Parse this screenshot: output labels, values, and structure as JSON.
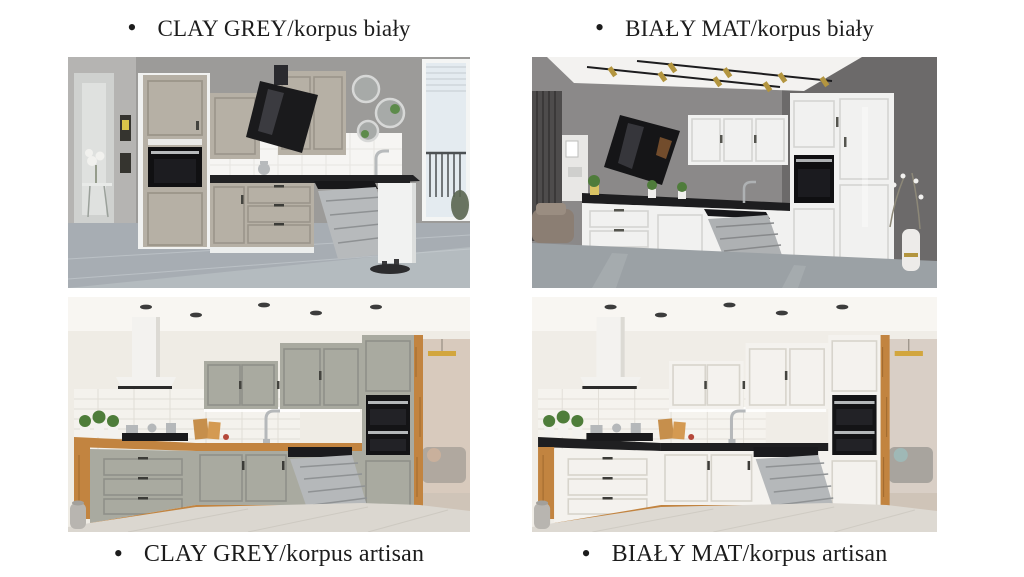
{
  "page": {
    "colors": {
      "bg": "#ffffff",
      "text": "#1c1c1c"
    }
  },
  "cards": [
    {
      "id": "clay-grey-korpus-bialy",
      "bullet": "•",
      "label": "CLAY GREY/korpus biały",
      "colors": {
        "wall": "#9c9b99",
        "wall_light": "#b5b4b2",
        "doorway": "#cfd1cf",
        "floor": "#a7adb3",
        "floor_light": "#c6cbcf",
        "front": "#b6b0a5",
        "front_dark": "#9b958a",
        "korpus": "#f1f2f1",
        "counter": "#212123",
        "splash": "#f6f5f3",
        "tile_line": "#e7e5e1",
        "hood": "#1a1a1c",
        "hood_glare": "#4a4a50",
        "appliance": "#101012",
        "steel": "#b7babc",
        "rack": "#8e9193",
        "window_frame": "#f4f5f4",
        "window_pane": "#e4ebf0",
        "railing": "#4c5053",
        "mirror": "#a7aaa8",
        "mirror_green": "#5d8b4b",
        "plant_white": "#f1f1ee",
        "tray": "#2c2c2e"
      }
    },
    {
      "id": "bialy-mat-korpus-bialy",
      "bullet": "•",
      "label": "BIAŁY MAT/korpus biały",
      "colors": {
        "wall": "#8b8989",
        "wall_dark": "#6c6a6a",
        "ceiling": "#f3f2f0",
        "floor": "#9ba1a5",
        "floor_sheen": "#b7bcbf",
        "front": "#f1f1f0",
        "front_line": "#d4d4d2",
        "counter": "#1d1d1f",
        "hood": "#151517",
        "hood_glare": "#3f3f45",
        "glint": "#8a5a32",
        "appliance": "#0f0f11",
        "steel": "#aeb1b3",
        "rack": "#87898b",
        "brass": "#b3953f",
        "rail": "#1c1c1e",
        "curtain": "#4e4c4c",
        "curtain_dark": "#3b3939",
        "shelf": "#e8e7e5",
        "sofa": "#8b7e73",
        "vase": "#edebe9",
        "vase_gold": "#b3953f",
        "branch": "#8d8878",
        "plant": "#4f7c3b",
        "pot_yellow": "#d9c364"
      }
    },
    {
      "id": "clay-grey-korpus-artisan",
      "bullet": "•",
      "label": "CLAY GREY/korpus artisan",
      "colors": {
        "wall": "#efece5",
        "ceiling": "#f8f6f2",
        "spot": "#3c3c3c",
        "tile": "#f4f2ed",
        "tile_line": "#e1ded7",
        "front": "#a9aaa0",
        "front_dark": "#8f9089",
        "oak": "#c28440",
        "oak_dark": "#a06a2e",
        "oak_light": "#d49a52",
        "counter": "#c28440",
        "hood": "#f3f2ef",
        "hood_shade": "#dcdad4",
        "hood_trim": "#2b2b2b",
        "appliance": "#141416",
        "steel": "#b5b8ba",
        "rack": "#8f9294",
        "floor": "#dbd7d0",
        "floor_line": "#cdc9c1",
        "door": "#d8cabd",
        "door_lamp": "#d2a63e",
        "door_sofa": "#b0a89f",
        "door_accent": "#c9b09c",
        "plant": "#4e7d3a",
        "pot": "#f3f2ef",
        "jar": "#b8b5b0",
        "board": "#c68f4c",
        "hob": "#1a1a1c"
      }
    },
    {
      "id": "bialy-mat-korpus-artisan",
      "bullet": "•",
      "label": "BIAŁY MAT/korpus artisan",
      "colors": {
        "wall": "#f0ede7",
        "ceiling": "#f8f6f2",
        "spot": "#3c3c3c",
        "tile": "#f5f3ee",
        "tile_line": "#e2dfd8",
        "front": "#f4f2ee",
        "front_dark": "#d7d4cc",
        "oak": "#c28440",
        "oak_dark": "#a06a2e",
        "oak_light": "#d49a52",
        "counter": "#1f1f21",
        "hood": "#f3f2ef",
        "hood_shade": "#dcdad4",
        "hood_trim": "#2b2b2b",
        "appliance": "#141416",
        "steel": "#b5b8ba",
        "rack": "#8f9294",
        "floor": "#ddd9d2",
        "floor_line": "#cfcbc3",
        "door": "#d9cfc6",
        "door_lamp": "#d2a63e",
        "door_sofa": "#a8a49e",
        "door_accent": "#9fb8b6",
        "plant": "#4e7d3a",
        "pot": "#f3f2ef",
        "jar": "#b8b5b0",
        "board": "#c68f4c",
        "hob": "#1a1a1c"
      }
    }
  ]
}
